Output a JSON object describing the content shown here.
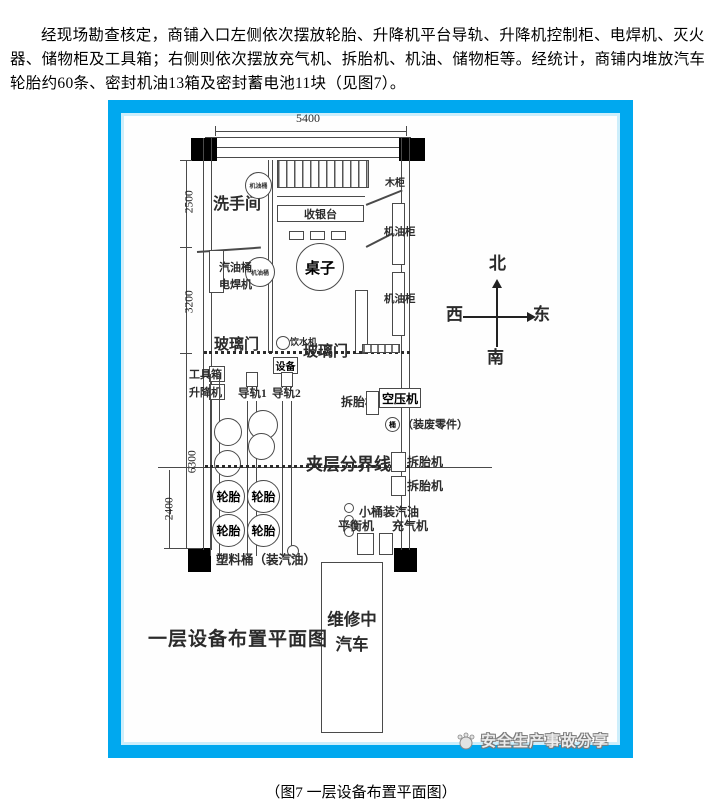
{
  "document": {
    "intro_paragraph": "经现场勘查核定，商铺入口左侧依次摆放轮胎、升降机平台导轨、升降机控制柜、电焊机、灭火器、储物柜及工具箱；右侧则依次摆放充气机、拆胎机、机油、储物柜等。经统计，商铺内堆放汽车轮胎约60条、密封机油13箱及密封蓄电池11块（见图7）。",
    "figure_caption": "（图7 一层设备布置平面图）"
  },
  "diagram": {
    "plan_title": "一层设备布置平面图",
    "watermark_text": "安全生产事故分享",
    "compass": {
      "north": "北",
      "south": "南",
      "west": "西",
      "east": "东"
    },
    "dimensions": {
      "top_width": "5400",
      "washroom_depth": "2500",
      "mid_depth": "3200",
      "hall_depth": "6300",
      "mezzanine_depth": "2400"
    },
    "labels": {
      "washroom": "洗手间",
      "oil_drum": "机油桶",
      "cashier_counter": "收银台",
      "table": "桌子",
      "wood_cabinet": "木柜",
      "oil_cabinet": "机油柜",
      "gasoline_drum": "汽油桶",
      "welder": "电焊机",
      "glass_door": "玻璃门",
      "water_dispenser": "饮水机",
      "equipment": "设备",
      "toolbox": "工具箱",
      "lift": "升降机",
      "rail_1": "导轨1",
      "rail_2": "导轨2",
      "tire_changer": "拆胎机",
      "air_compressor": "空压机",
      "waste_bucket": "桶",
      "waste_bucket_note": "（装废零件）",
      "mezzanine_line": "夹层分界线",
      "tire": "轮胎",
      "small_gasoline_buckets": "小桶装汽油",
      "balancer": "平衡机",
      "inflator": "充气机",
      "plastic_bucket": "塑料桶（装汽油）",
      "car_line1": "维修中",
      "car_line2": "汽车"
    }
  }
}
